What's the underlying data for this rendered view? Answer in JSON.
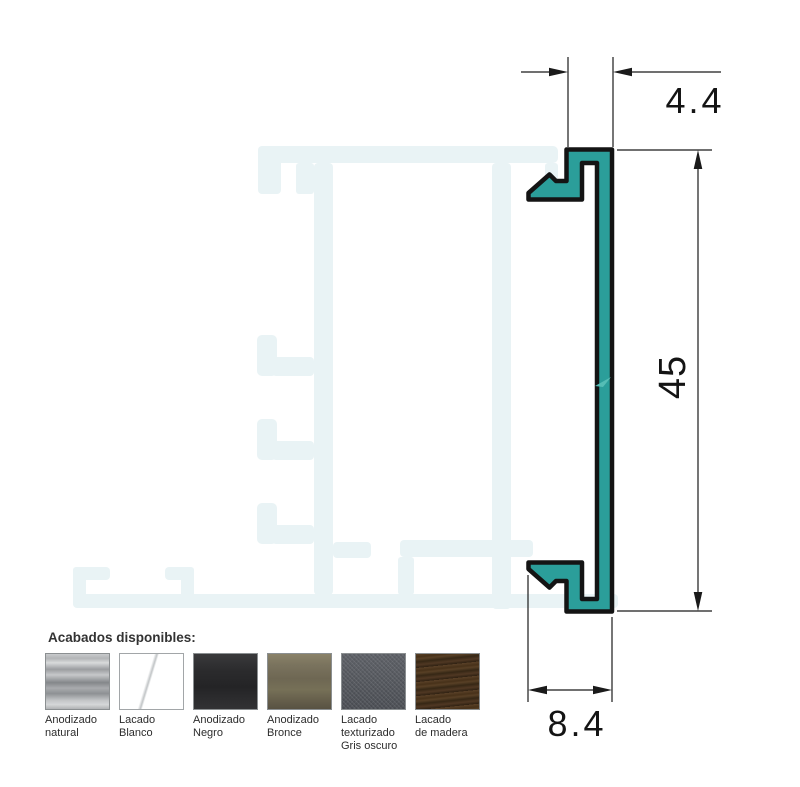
{
  "drawing": {
    "description": "Aluminium clip-on cover profile cross-section with ghost frame profile behind",
    "dimensions": {
      "top": "4.4",
      "right": "45",
      "bottom": "8.4"
    },
    "profile_color": "#2b9e9a",
    "outline_color": "#141414",
    "ghost_color": "#e9f3f5"
  },
  "finishes": {
    "title": "Acabados disponibles:",
    "items": [
      {
        "label": "Anodizado\nnatural",
        "color": "#a9abad"
      },
      {
        "label": "Lacado\nBlanco",
        "color": "#ffffff"
      },
      {
        "label": "Anodizado\nNegro",
        "color": "#2d2d2f"
      },
      {
        "label": "Anodizado\nBronce",
        "color": "#736c58"
      },
      {
        "label": "Lacado\ntexturizado\nGris oscuro",
        "color": "#53565c"
      },
      {
        "label": "Lacado\nde madera",
        "color": "#47311f"
      }
    ]
  }
}
